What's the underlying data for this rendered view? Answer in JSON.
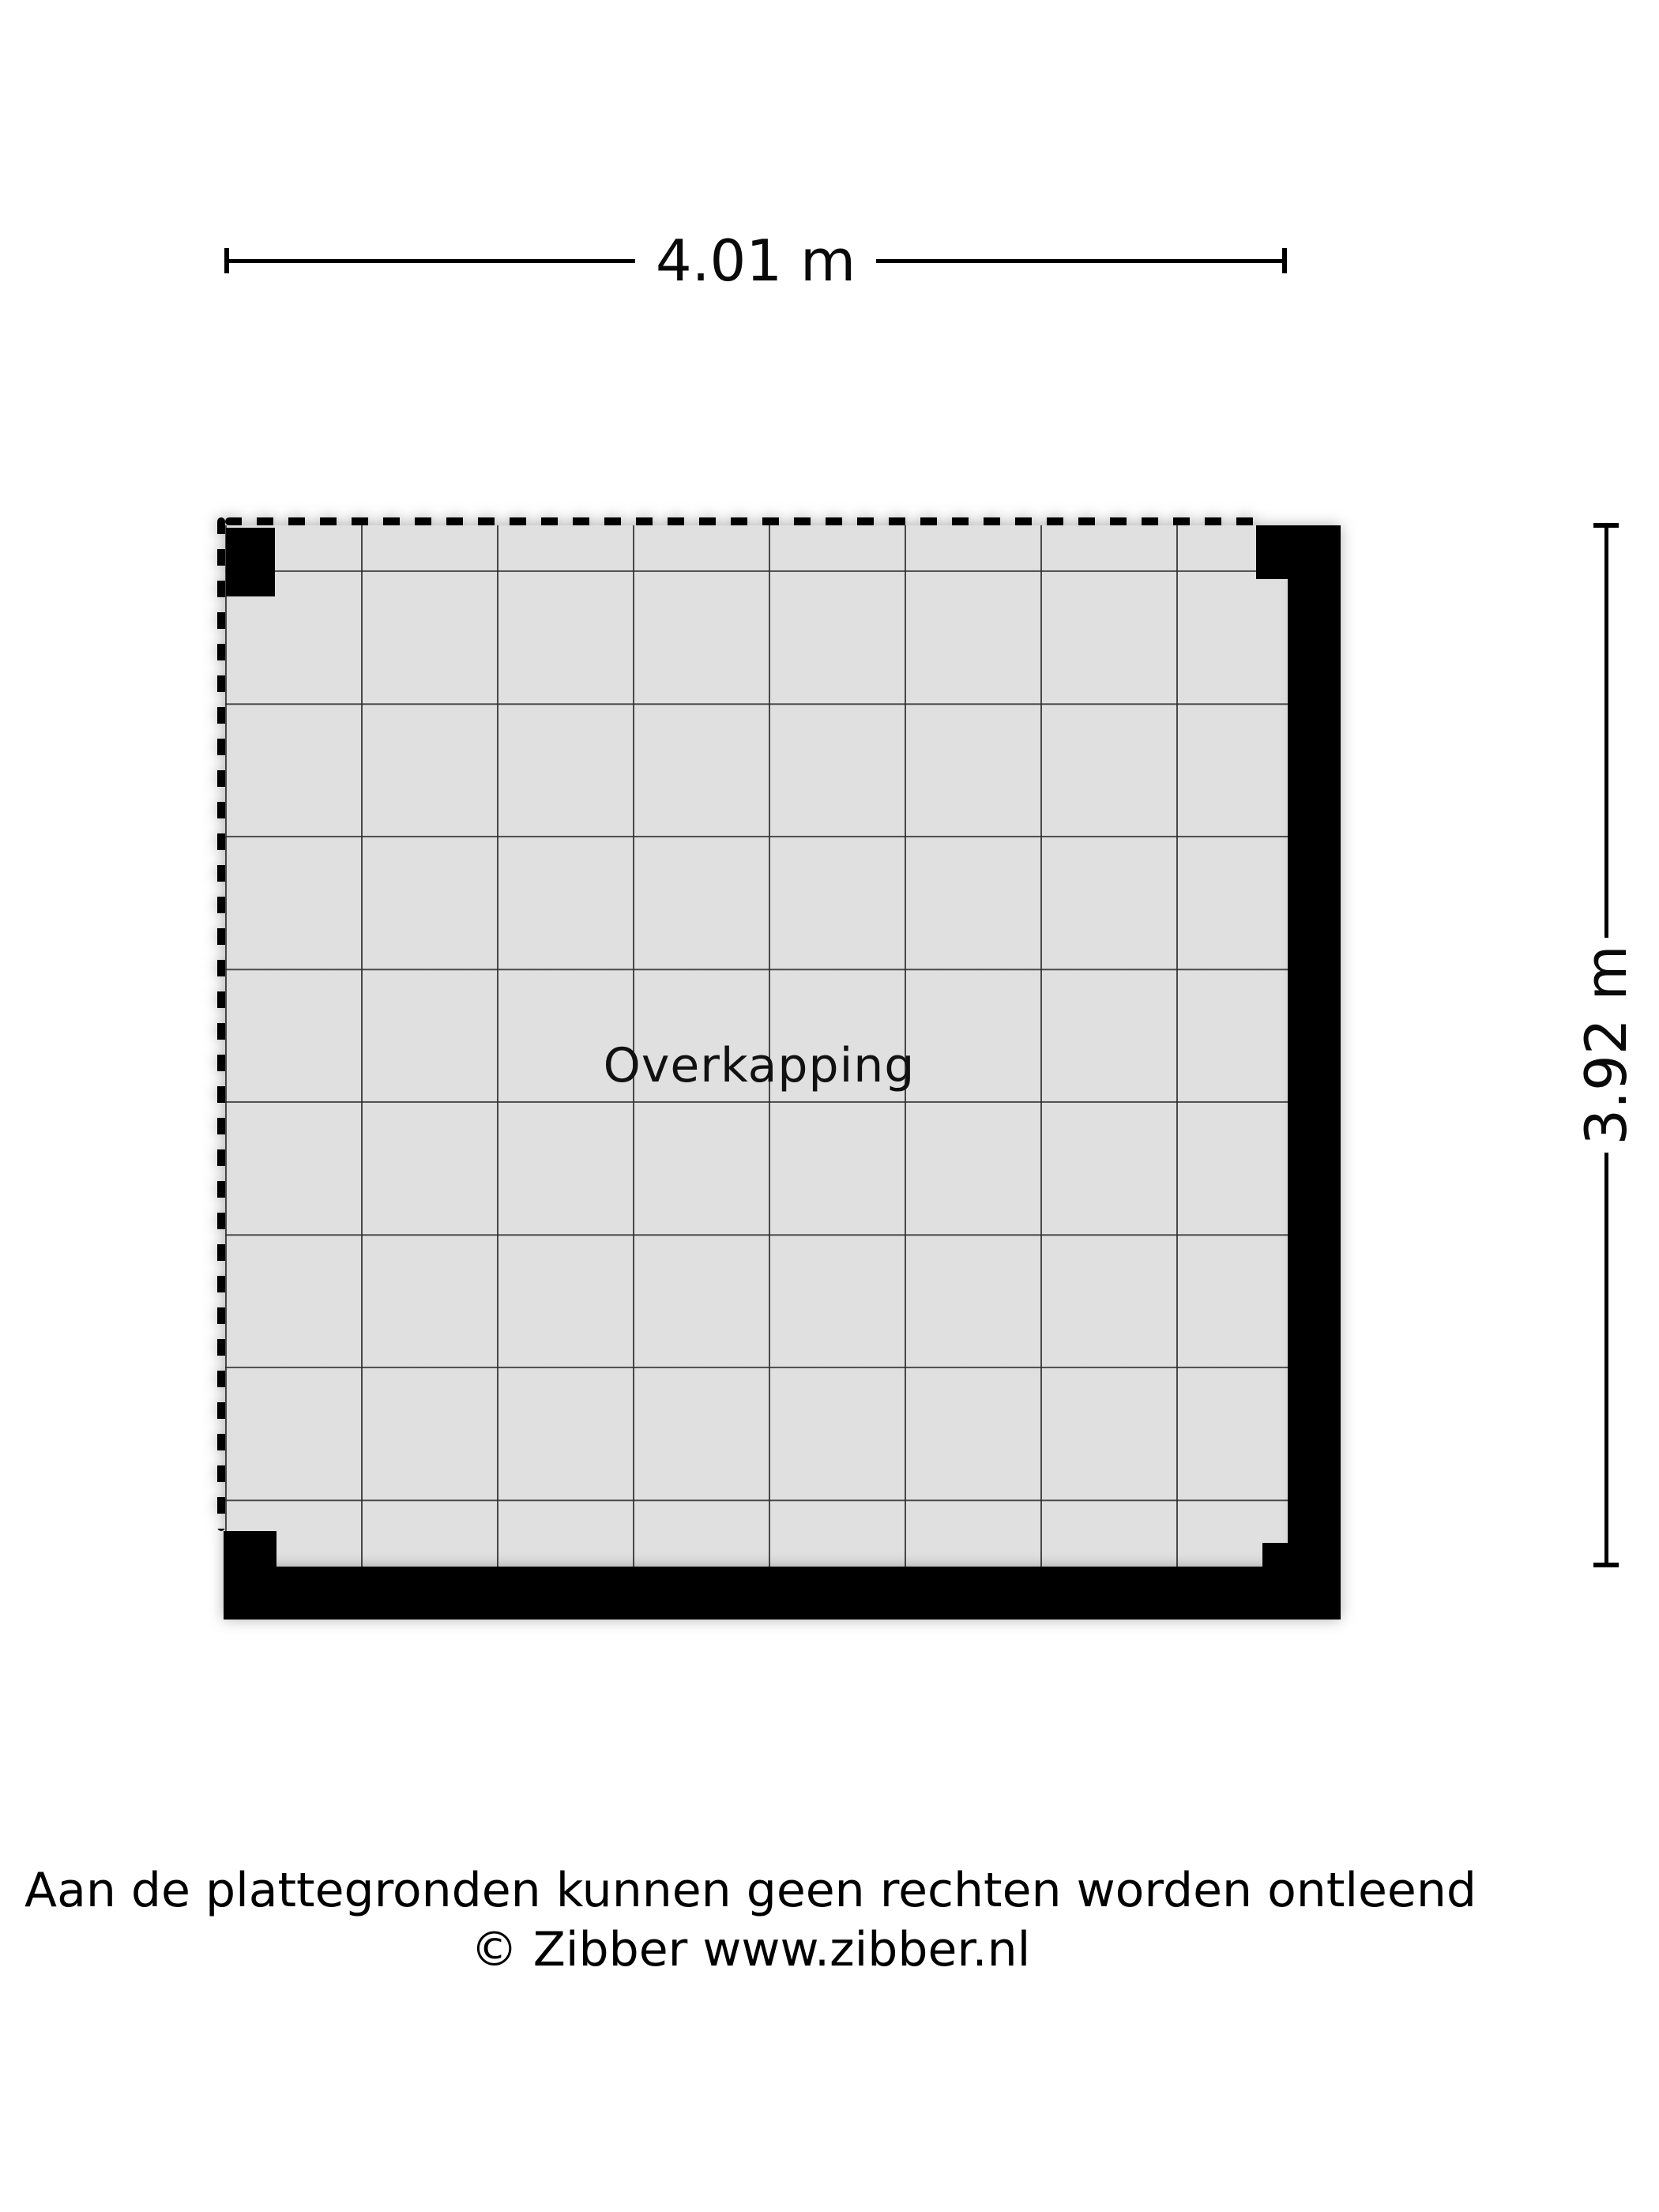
{
  "plan": {
    "room": {
      "label": "Overkapping"
    },
    "dimensions": {
      "width_label": "4.01 m",
      "height_label": "3.92 m"
    },
    "colors": {
      "wall": "#000000",
      "floor": "#e0e0e0",
      "grid_line": "#2d2d2d",
      "text": "#000000",
      "background": "#ffffff"
    }
  },
  "footer": {
    "disclaimer_line1": "Aan de plattegronden kunnen geen rechten worden ontleend",
    "disclaimer_line2": "© Zibber www.zibber.nl"
  }
}
